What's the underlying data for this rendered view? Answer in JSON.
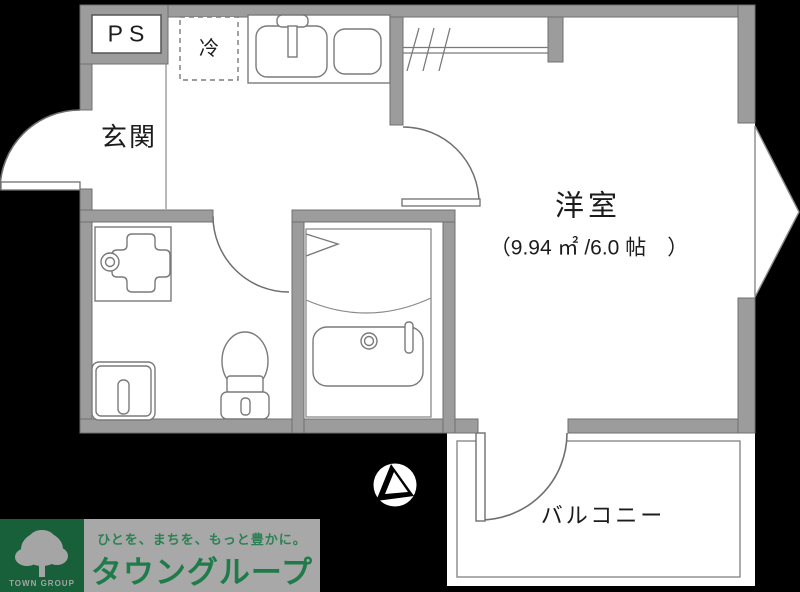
{
  "plan": {
    "ps_label": "PS",
    "fridge_label": "冷",
    "entrance_label": "玄関",
    "room_label": "洋室",
    "room_size_label": "（9.94 ㎡ /6.0 帖　）",
    "balcony_label": "バルコニー"
  },
  "logo": {
    "tagline": "ひとを、まちを、もっと豊かに。",
    "company_name": "タウングループ",
    "group_label": "TOWN GROUP"
  },
  "colors": {
    "background": "#000000",
    "wall": "#9c9c9c",
    "wall_edge": "#6f6f6f",
    "floor": "#ffffff",
    "fixture_line": "#7a7a7a",
    "logo_green_box": "#17603a",
    "logo_gray_band": "#a8a8a8",
    "logo_text_green": "#1f7c4a"
  }
}
